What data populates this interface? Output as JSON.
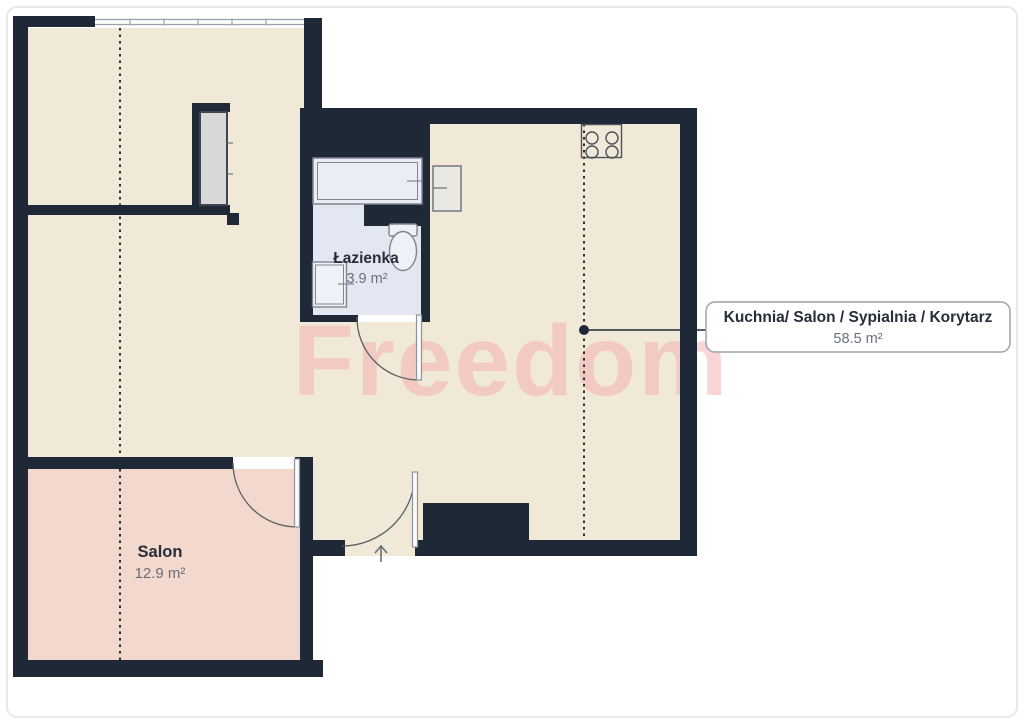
{
  "watermark": {
    "text": "Freedom",
    "color": "#f5acae"
  },
  "rooms": {
    "bathroom": {
      "label": "Łazienka",
      "area": "3.9 m²"
    },
    "salon": {
      "label": "Salon",
      "area": "12.9 m²"
    },
    "open_space": {
      "label": "Kuchnia/ Salon / Sypialnia / Korytarz",
      "area": "58.5 m²"
    }
  },
  "label_box": {
    "title": "Kuchnia/ Salon / Sypialnia / Korytarz",
    "area": "58.5 m²"
  },
  "colors": {
    "wall": "#1f2836",
    "floor": "#f1e9d7",
    "salon_floor": "#f3d9cd",
    "bathroom_floor": "#e3e7f1",
    "fixture_fill": "#eef1f8",
    "fixture_stroke": "#80858f",
    "text_dark": "#272e3a",
    "text_gray": "#68707c",
    "frame": "#e6e8eb"
  }
}
